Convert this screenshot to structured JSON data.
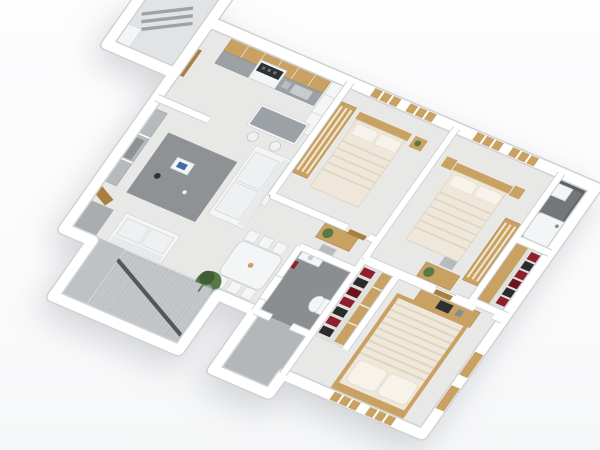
{
  "meta": {
    "description": "3D isometric architectural rendering of a three-bedroom apartment floor plan on a white background, rotated clockwise about 25 degrees",
    "view": "top-down axonometric white-model render",
    "visible_text": ""
  },
  "palette": {
    "background": "#fdfdfe",
    "wall": "#ffffff",
    "wall_edge": "#d0d3d5",
    "floor": "#e8e9e6",
    "floor_room": "#e5e6e2",
    "floor_balcony": "#e1e3e4",
    "floor_entry_dark": "#a9adaf",
    "stair_floor": "#cfd2d4",
    "stair_tread": "#c3c6c8",
    "stair_rail": "#55585b",
    "bath_floor": "#8b8e91",
    "bath_dark": "#5e6164",
    "bath_east_floor": "#74777a",
    "balcony_gray": "#b4b7b9",
    "closet_floor": "#dfe1dd",
    "rug": "#8e9295",
    "wood": "#c9a263",
    "wood_dark": "#a97f3f",
    "granite": "#9ba1a5",
    "linen": "#efe8da",
    "linen_fold": "#dfd6c2",
    "pillow": "#f7f3ea",
    "white_furn": "#f4f5f6",
    "furn_stroke": "#d6d9db",
    "seat": "#eef0f1",
    "plant": "#567a45",
    "plant_dark": "#3f5e33",
    "clothes_red": "#8f1f2c",
    "clothes_dark": "#2b2b2e",
    "metal": "#9da2a5",
    "screen_dark": "#2e3032",
    "console": "#b6babc"
  },
  "scene": {
    "type": "floor-plan-3d-render",
    "rooms": [
      {
        "name": "kitchen",
        "furniture": [
          "wood upper cabinets",
          "granite counter",
          "stove",
          "sink",
          "tall white cabinets",
          "island with two stools",
          "balcony door"
        ]
      },
      {
        "name": "laundry-balcony-northwest",
        "furniture": [
          "drying racks",
          "bench"
        ]
      },
      {
        "name": "living-room",
        "furniture": [
          "white three-seat sofa",
          "wall art",
          "gray rug with tray and kettle",
          "media console",
          "white loveseat",
          "entry door"
        ]
      },
      {
        "name": "dining-area",
        "furniture": [
          "white dining table",
          "six white chairs",
          "potted plant"
        ]
      },
      {
        "name": "hallway",
        "furniture": [
          "desk with plant",
          "chair"
        ]
      },
      {
        "name": "bedroom-1",
        "furniture": [
          "double bed with cream linen",
          "wardrobe",
          "nightstand",
          "two windows",
          "desk"
        ]
      },
      {
        "name": "bedroom-2",
        "furniture": [
          "double bed with cream linen",
          "two nightstands",
          "wardrobe",
          "desk with plant",
          "two windows"
        ]
      },
      {
        "name": "master-bedroom",
        "furniture": [
          "large bed with ruffled cream duvet and two pillows",
          "desk with laptop",
          "windows on south and east walls"
        ]
      },
      {
        "name": "master-walk-in-closet",
        "furniture": [
          "hanging clothes in red and dark tones",
          "wood shelving"
        ]
      },
      {
        "name": "center-bathroom",
        "furniture": [
          "white door",
          "toilet",
          "vanity",
          "red towel"
        ]
      },
      {
        "name": "east-bathroom",
        "furniture": [
          "white bathtub",
          "vanity",
          "dark tiled walls"
        ]
      },
      {
        "name": "east-closet",
        "furniture": [
          "hanging clothes in red and dark tones"
        ]
      },
      {
        "name": "rear-gray-balcony",
        "furniture": []
      },
      {
        "name": "staircase",
        "furniture": [
          "gray carpeted steps",
          "dark handrail",
          "landing"
        ]
      }
    ]
  }
}
